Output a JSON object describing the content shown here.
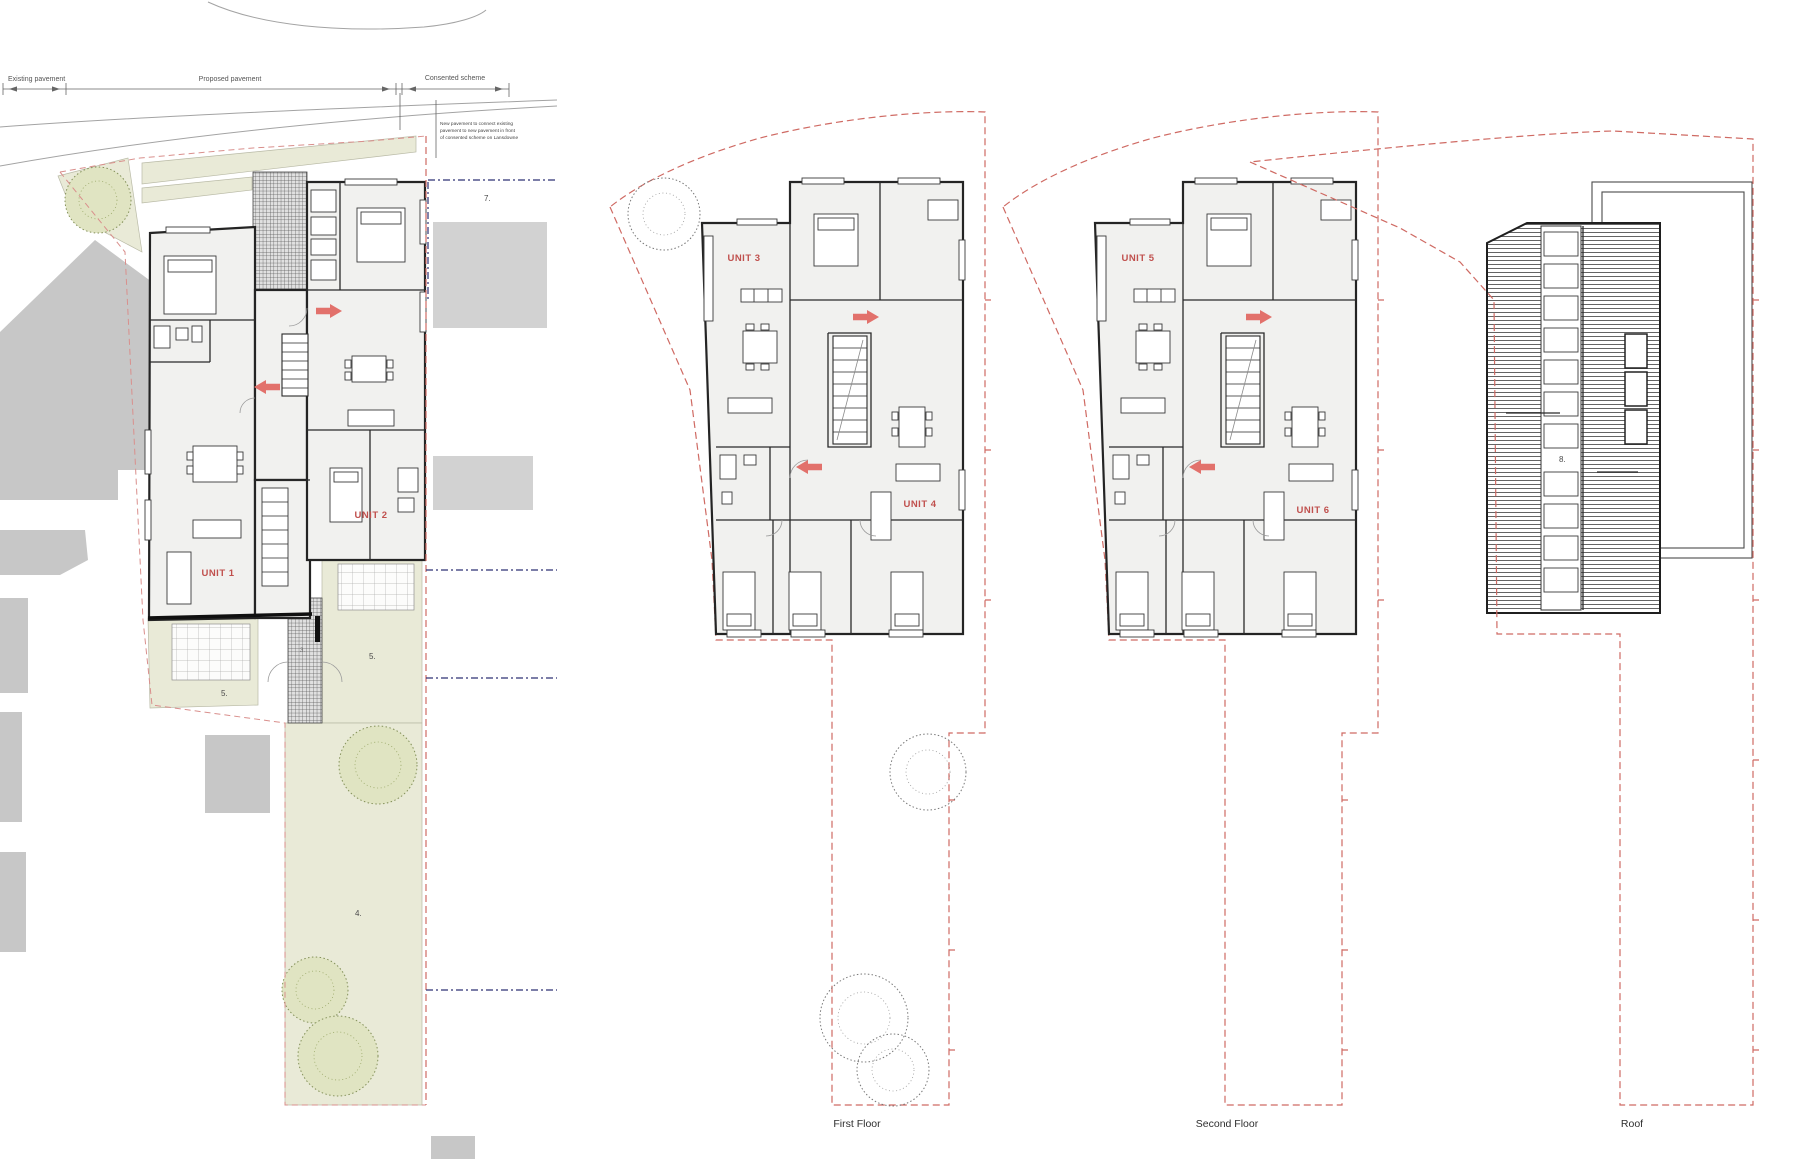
{
  "drawing": {
    "site_plan": {
      "dim_existing": "Existing pavement",
      "dim_proposed": "Proposed pavement",
      "dim_consented": "Consented scheme",
      "note_line1": "New pavement to connect existing",
      "note_line2": "pavement to new pavement in front",
      "note_line3": "of consented scheme on Lansdowne",
      "unit1": "UNIT 1",
      "unit2": "UNIT 2",
      "label_consented_area": "7.",
      "label_patio_left": "5.",
      "label_patio_right": "5.",
      "label_garden": "4.",
      "label_path": "3."
    },
    "first_floor": {
      "unit3": "UNIT 3",
      "unit4": "UNIT 4",
      "caption": "First Floor"
    },
    "second_floor": {
      "unit5": "UNIT 5",
      "unit6": "UNIT 6",
      "caption": "Second Floor"
    },
    "roof_plan": {
      "label_roof": "8.",
      "caption": "Roof"
    },
    "colors": {
      "boundary_red": "#cf6a63",
      "unit_label_red": "#c0504d",
      "entrance_arrow_red": "#e2716b",
      "landscape_green": "#e9ead7",
      "neighbour_building_gray": "#c7c7c7",
      "consented_line_blue": "#2e3173"
    }
  }
}
